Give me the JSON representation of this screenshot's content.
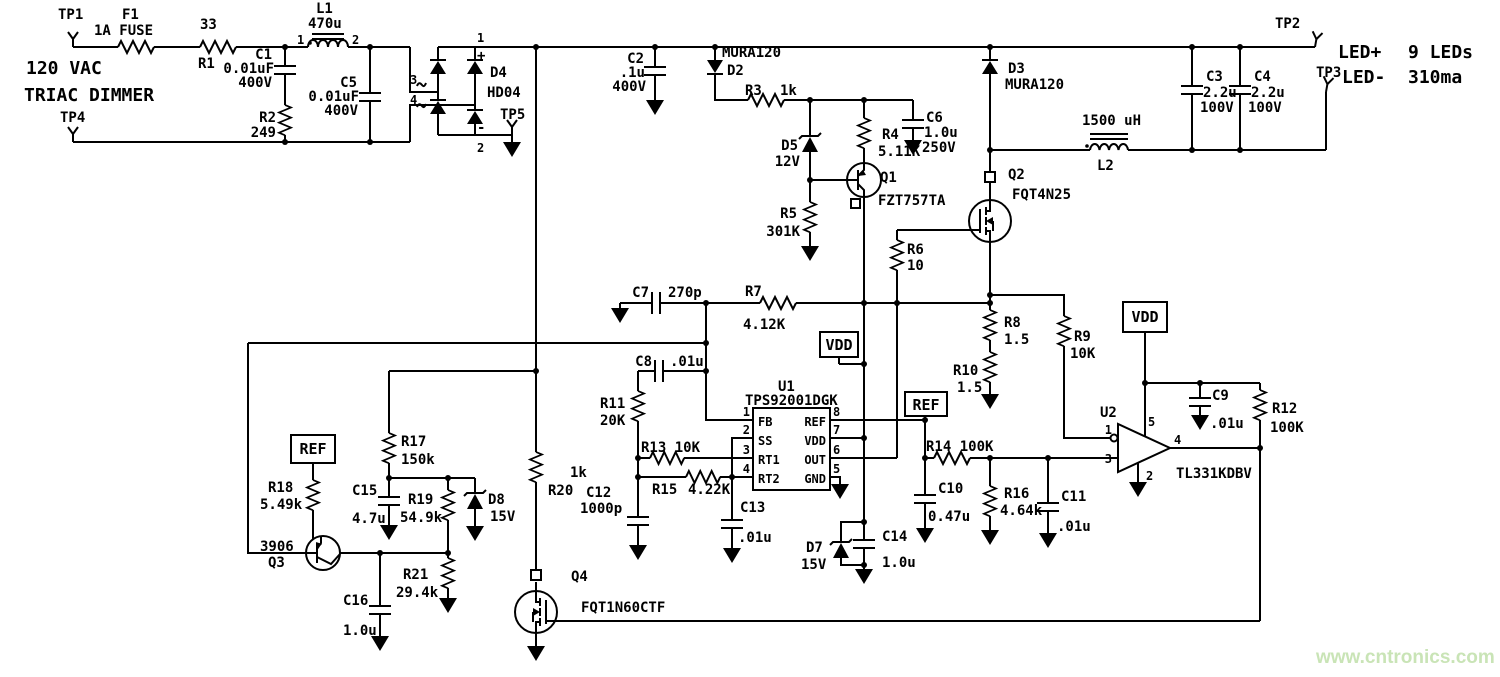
{
  "page": {
    "watermark": "www.cntronics.com",
    "watermark_color": "#c9e4b6",
    "ink": "#000000",
    "background": "#ffffff"
  },
  "input": {
    "tp1": "TP1",
    "tp4": "TP4",
    "source_line1": "120 VAC",
    "source_line2": "TRIAC DIMMER",
    "f1_ref": "F1",
    "f1_val": "1A FUSE",
    "r1_val": "33",
    "r1_ref": "R1",
    "l1_ref": "L1",
    "l1_val": "470u",
    "l1_pin1": "1",
    "l1_pin2": "2",
    "c1_ref": "C1",
    "c1_val": "0.01uF",
    "c1_volt": "400V",
    "r2_ref": "R2",
    "r2_val": "249",
    "c5_ref": "C5",
    "c5_val": "0.01uF",
    "c5_volt": "400V"
  },
  "bridge": {
    "ref": "D4",
    "part": "HD04",
    "pin1": "1",
    "pin2": "2",
    "pin3": "3",
    "pin4": "4",
    "plus": "+",
    "minus": "-",
    "tp5": "TP5"
  },
  "hvrail": {
    "c2_ref": "C2",
    "c2_val": ".1u",
    "c2_volt": "400V",
    "d2_part": "MURA120",
    "d2_ref": "D2",
    "r3_ref": "R3",
    "r3_val": "1k",
    "d5_ref": "D5",
    "d5_val": "12V",
    "r4_ref": "R4",
    "r4_val": "5.11K",
    "c6_ref": "C6",
    "c6_val": "1.0u",
    "c6_volt": "250V",
    "q1_ref": "Q1",
    "q1_part": "FZT757TA",
    "r5_ref": "R5",
    "r5_val": "301K",
    "r6_ref": "R6",
    "r6_val": "10"
  },
  "output": {
    "d3_ref": "D3",
    "d3_part": "MURA120",
    "q2_ref": "Q2",
    "q2_part": "FQT4N25",
    "l2_val": "1500 uH",
    "l2_ref": "L2",
    "c3_ref": "C3",
    "c3_val": "2.2u",
    "c3_volt": "100V",
    "c4_ref": "C4",
    "c4_val": "2.2u",
    "c4_volt": "100V",
    "tp2": "TP2",
    "tp3": "TP3",
    "led_plus": "LED+",
    "led_count": "9 LEDs",
    "led_minus": "LED-",
    "led_current": "310ma",
    "r8_ref": "R8",
    "r8_val": "1.5",
    "r10_ref": "R10",
    "r10_val": "1.5",
    "r9_ref": "R9",
    "r9_val": "10K"
  },
  "controller": {
    "u1_ref": "U1",
    "u1_part": "TPS92001DGK",
    "pin_fb": "FB",
    "pin_ss": "SS",
    "pin_rt1": "RT1",
    "pin_rt2": "RT2",
    "pin_ref": "REF",
    "pin_vdd": "VDD",
    "pin_out": "OUT",
    "pin_gnd": "GND",
    "n1": "1",
    "n2": "2",
    "n3": "3",
    "n4": "4",
    "n5": "5",
    "n6": "6",
    "n7": "7",
    "n8": "8",
    "vdd_flag": "VDD",
    "ref_flag": "REF",
    "c7_ref": "C7",
    "c7_val": "270p",
    "r7_ref": "R7",
    "r7_val": "4.12K",
    "c8_ref": "C8",
    "c8_val": ".01u",
    "r11_ref": "R11",
    "r11_val": "20K",
    "r13_label": "R13 10K",
    "r15_ref": "R15",
    "r15_val": "4.22K",
    "c12_ref": "C12",
    "c12_val": "1000p",
    "c13_ref": "C13",
    "c13_val": ".01u",
    "r14_label": "R14 100K",
    "c10_ref": "C10",
    "c10_val": "0.47u",
    "r16_ref": "R16",
    "r16_val": "4.64k",
    "c11_ref": "C11",
    "c11_val": ".01u",
    "d7_ref": "D7",
    "d7_val": "15V",
    "c14_ref": "C14",
    "c14_val": "1.0u"
  },
  "dimmer": {
    "ref_flag": "REF",
    "r18_ref": "R18",
    "r18_val": "5.49k",
    "r17_ref": "R17",
    "r17_val": "150k",
    "c15_ref": "C15",
    "c15_val": "4.7u",
    "r19_ref": "R19",
    "r19_val": "54.9k",
    "d8_ref": "D8",
    "d8_val": "15V",
    "q3_part": "3906",
    "q3_ref": "Q3",
    "r21_ref": "R21",
    "r21_val": "29.4k",
    "c16_ref": "C16",
    "c16_val": "1.0u",
    "r20_val": "1k",
    "r20_ref": "R20",
    "q4_ref": "Q4",
    "q4_part": "FQT1N60CTF"
  },
  "comparator": {
    "u2_ref": "U2",
    "u2_part": "TL331KDBV",
    "n1": "1",
    "n2": "2",
    "n3": "3",
    "n4": "4",
    "n5": "5",
    "vdd_flag": "VDD",
    "c9_ref": "C9",
    "c9_val": ".01u",
    "r12_ref": "R12",
    "r12_val": "100K"
  }
}
